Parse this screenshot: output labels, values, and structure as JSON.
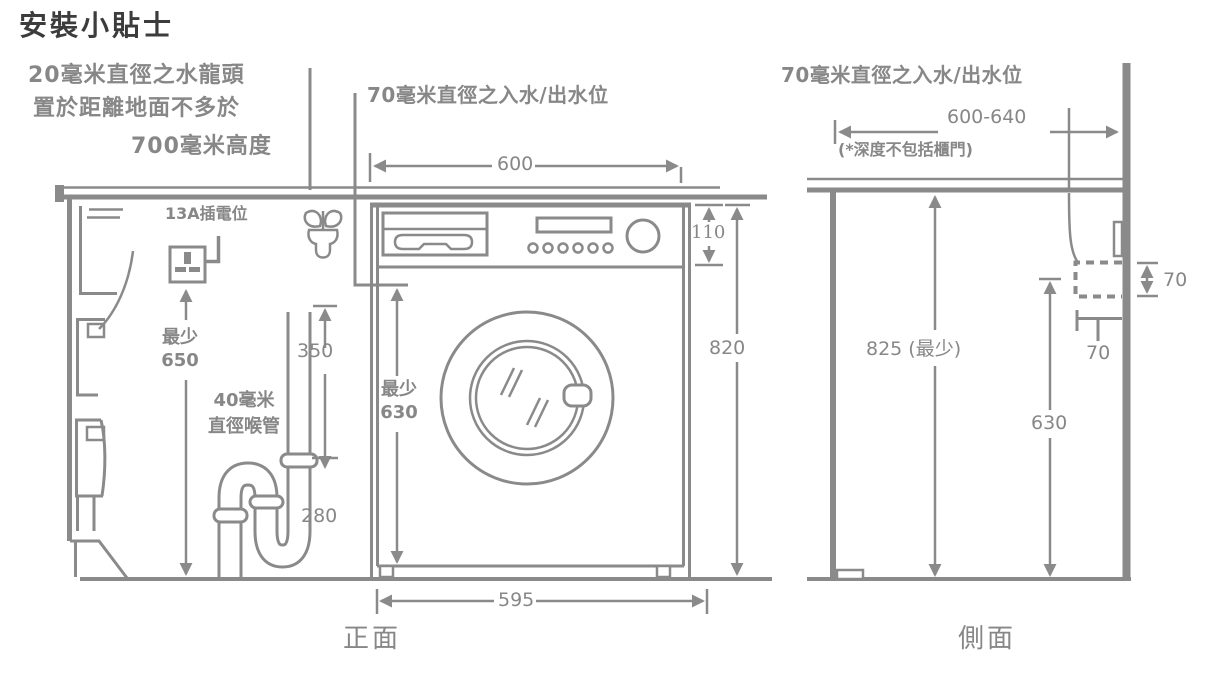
{
  "title": "安裝小貼士",
  "front": {
    "caption": "正面",
    "tap_note1": "20毫米直徑之水龍頭",
    "tap_note2": "置於距離地面不多於",
    "tap_note3": "700毫米高度",
    "inlet_note": "70毫米直徑之入水/出水位",
    "socket_label": "13A插電位",
    "pipe_label1": "40毫米",
    "pipe_label2": "直徑喉管",
    "dim_top_width": "600",
    "dim_panel_height": "110",
    "dim_total_height": "820",
    "dim_door_min_label": "最少",
    "dim_door_min_value": "630",
    "dim_socket_min_label": "最少",
    "dim_socket_min_value": "650",
    "dim_standpipe_height": "350",
    "dim_trap_height": "280",
    "dim_bottom_width": "595"
  },
  "side": {
    "caption": "側面",
    "inlet_note": "70毫米直徑之入水/出水位",
    "depth_note": "(*深度不包括櫃門)",
    "dim_depth_range": "600-640",
    "dim_height_min": "825 (最少)",
    "dim_inlet_height": "630",
    "dim_hole_height": "70",
    "dim_hole_depth": "70"
  },
  "colors": {
    "line": "#8a8a8a",
    "text": "#878787",
    "title": "#3c3c3c",
    "background": "#ffffff"
  }
}
